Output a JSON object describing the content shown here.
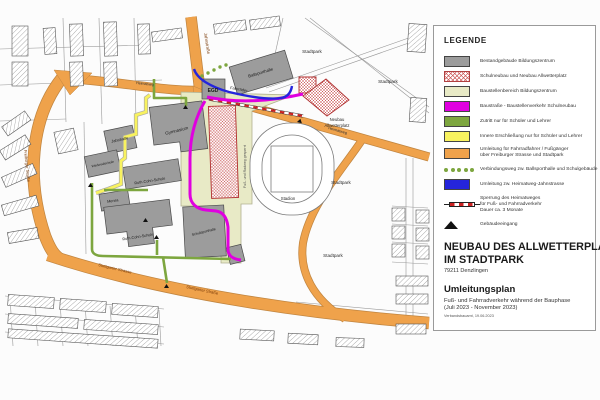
{
  "legend": {
    "title": "LEGENDE",
    "items": [
      {
        "name": "bestand",
        "label": "Bestandgebäude Bildungszentrum",
        "swatch": "solid",
        "color": "#9c9c9c"
      },
      {
        "name": "schulneubau",
        "label": "Schulneubau und Neubau Allwetterplatz",
        "swatch": "crosshatch",
        "color": "#cc5a5a"
      },
      {
        "name": "baustellenbereich",
        "label": "Baustellenbereich Bildungszentrum",
        "swatch": "solid",
        "color": "#e8eac6"
      },
      {
        "name": "baustrasse",
        "label": "Baustraße - Baustellenverkehr Schulneubau",
        "swatch": "solid",
        "color": "#e000e0"
      },
      {
        "name": "zutritt",
        "label": "Zutritt nur für Schüler und Lehrer",
        "swatch": "solid",
        "color": "#7da63f"
      },
      {
        "name": "innere-erschliessung",
        "label": "Innere Erschließung nur für Schüler und Lehrer",
        "swatch": "solid",
        "color": "#f8f25f"
      },
      {
        "name": "umleitung-fuss",
        "label": "Umleitung für Fahrradfahrer / Fußgänger",
        "label2": "über Freiburger Strasse und Stadtpark",
        "swatch": "solid",
        "color": "#efa24b"
      },
      {
        "name": "verbindungsweg",
        "label": "Verbindungsweg zw. Ballsporthalle und Schulgebäude",
        "swatch": "dots",
        "color": "#7da63f"
      },
      {
        "name": "umleitung-heimatweg",
        "label": "Umleitung zw. Heimatweg-Jahnstrasse",
        "swatch": "solid",
        "color": "#2525dc"
      },
      {
        "name": "sperrung",
        "label": "Sperrung des Heimatweges",
        "label2": "für Fuß- und Fahrradverkehr",
        "label3": "Dauer ca. 3 Monate",
        "swatch": "barrier",
        "color": "#cc2222"
      },
      {
        "name": "eingang",
        "label": "Gebäudeeingang",
        "swatch": "triangle",
        "color": "#111111"
      }
    ]
  },
  "title_block": {
    "line1": "NEUBAU DES ALLWETTERPLATZES",
    "line2": "IM STADTPARK",
    "address": "79211 Denzlingen",
    "subtitle": "Umleitungsplan",
    "desc1": "Fuß- und Fahrradverkehr während der Bauphase",
    "desc2": "(Juli 2023 - November 2023)",
    "stamp": "Verbandsbauamt, 19.06.2023"
  },
  "map": {
    "street_labels": {
      "jahnstrasse": "Jahnstraße",
      "heimatweg_west": "Heimatweg",
      "heimatweg_east": "Heimatweg",
      "freiburger": "Freiburger Straße",
      "stuttgarter_1": "Stuttgarter Strasse",
      "stuttgarter_2": "Stuttgarter Straße"
    },
    "building_labels": {
      "ballsporthalle": "Ballsporthalle",
      "egd": "EGD",
      "gymnasium": "Gymnasium",
      "jahnhalle": "Jahnhalle",
      "werkrealschule": "Werkrealschule",
      "ruth_cohn_1": "Ruth-Cohn-Schule",
      "mensa": "Mensa",
      "ruth_cohn_2": "Ruth-Cohn-Schule",
      "schulsporthalle": "Schulsporthalle"
    },
    "area_labels": {
      "stadion": "Stadion",
      "stadtpark_1": "Stadtpark",
      "stadtpark_2": "Stadtpark",
      "stadtpark_3": "Stadtpark",
      "stadtpark_4": "Stadtpark",
      "neubau_line1": "Neubau",
      "neubau_line2": "Allwetterplatz",
      "gesperrt": "Fuß- und Radweg gesperrt",
      "fahrraeder": "Fahrräder"
    }
  }
}
